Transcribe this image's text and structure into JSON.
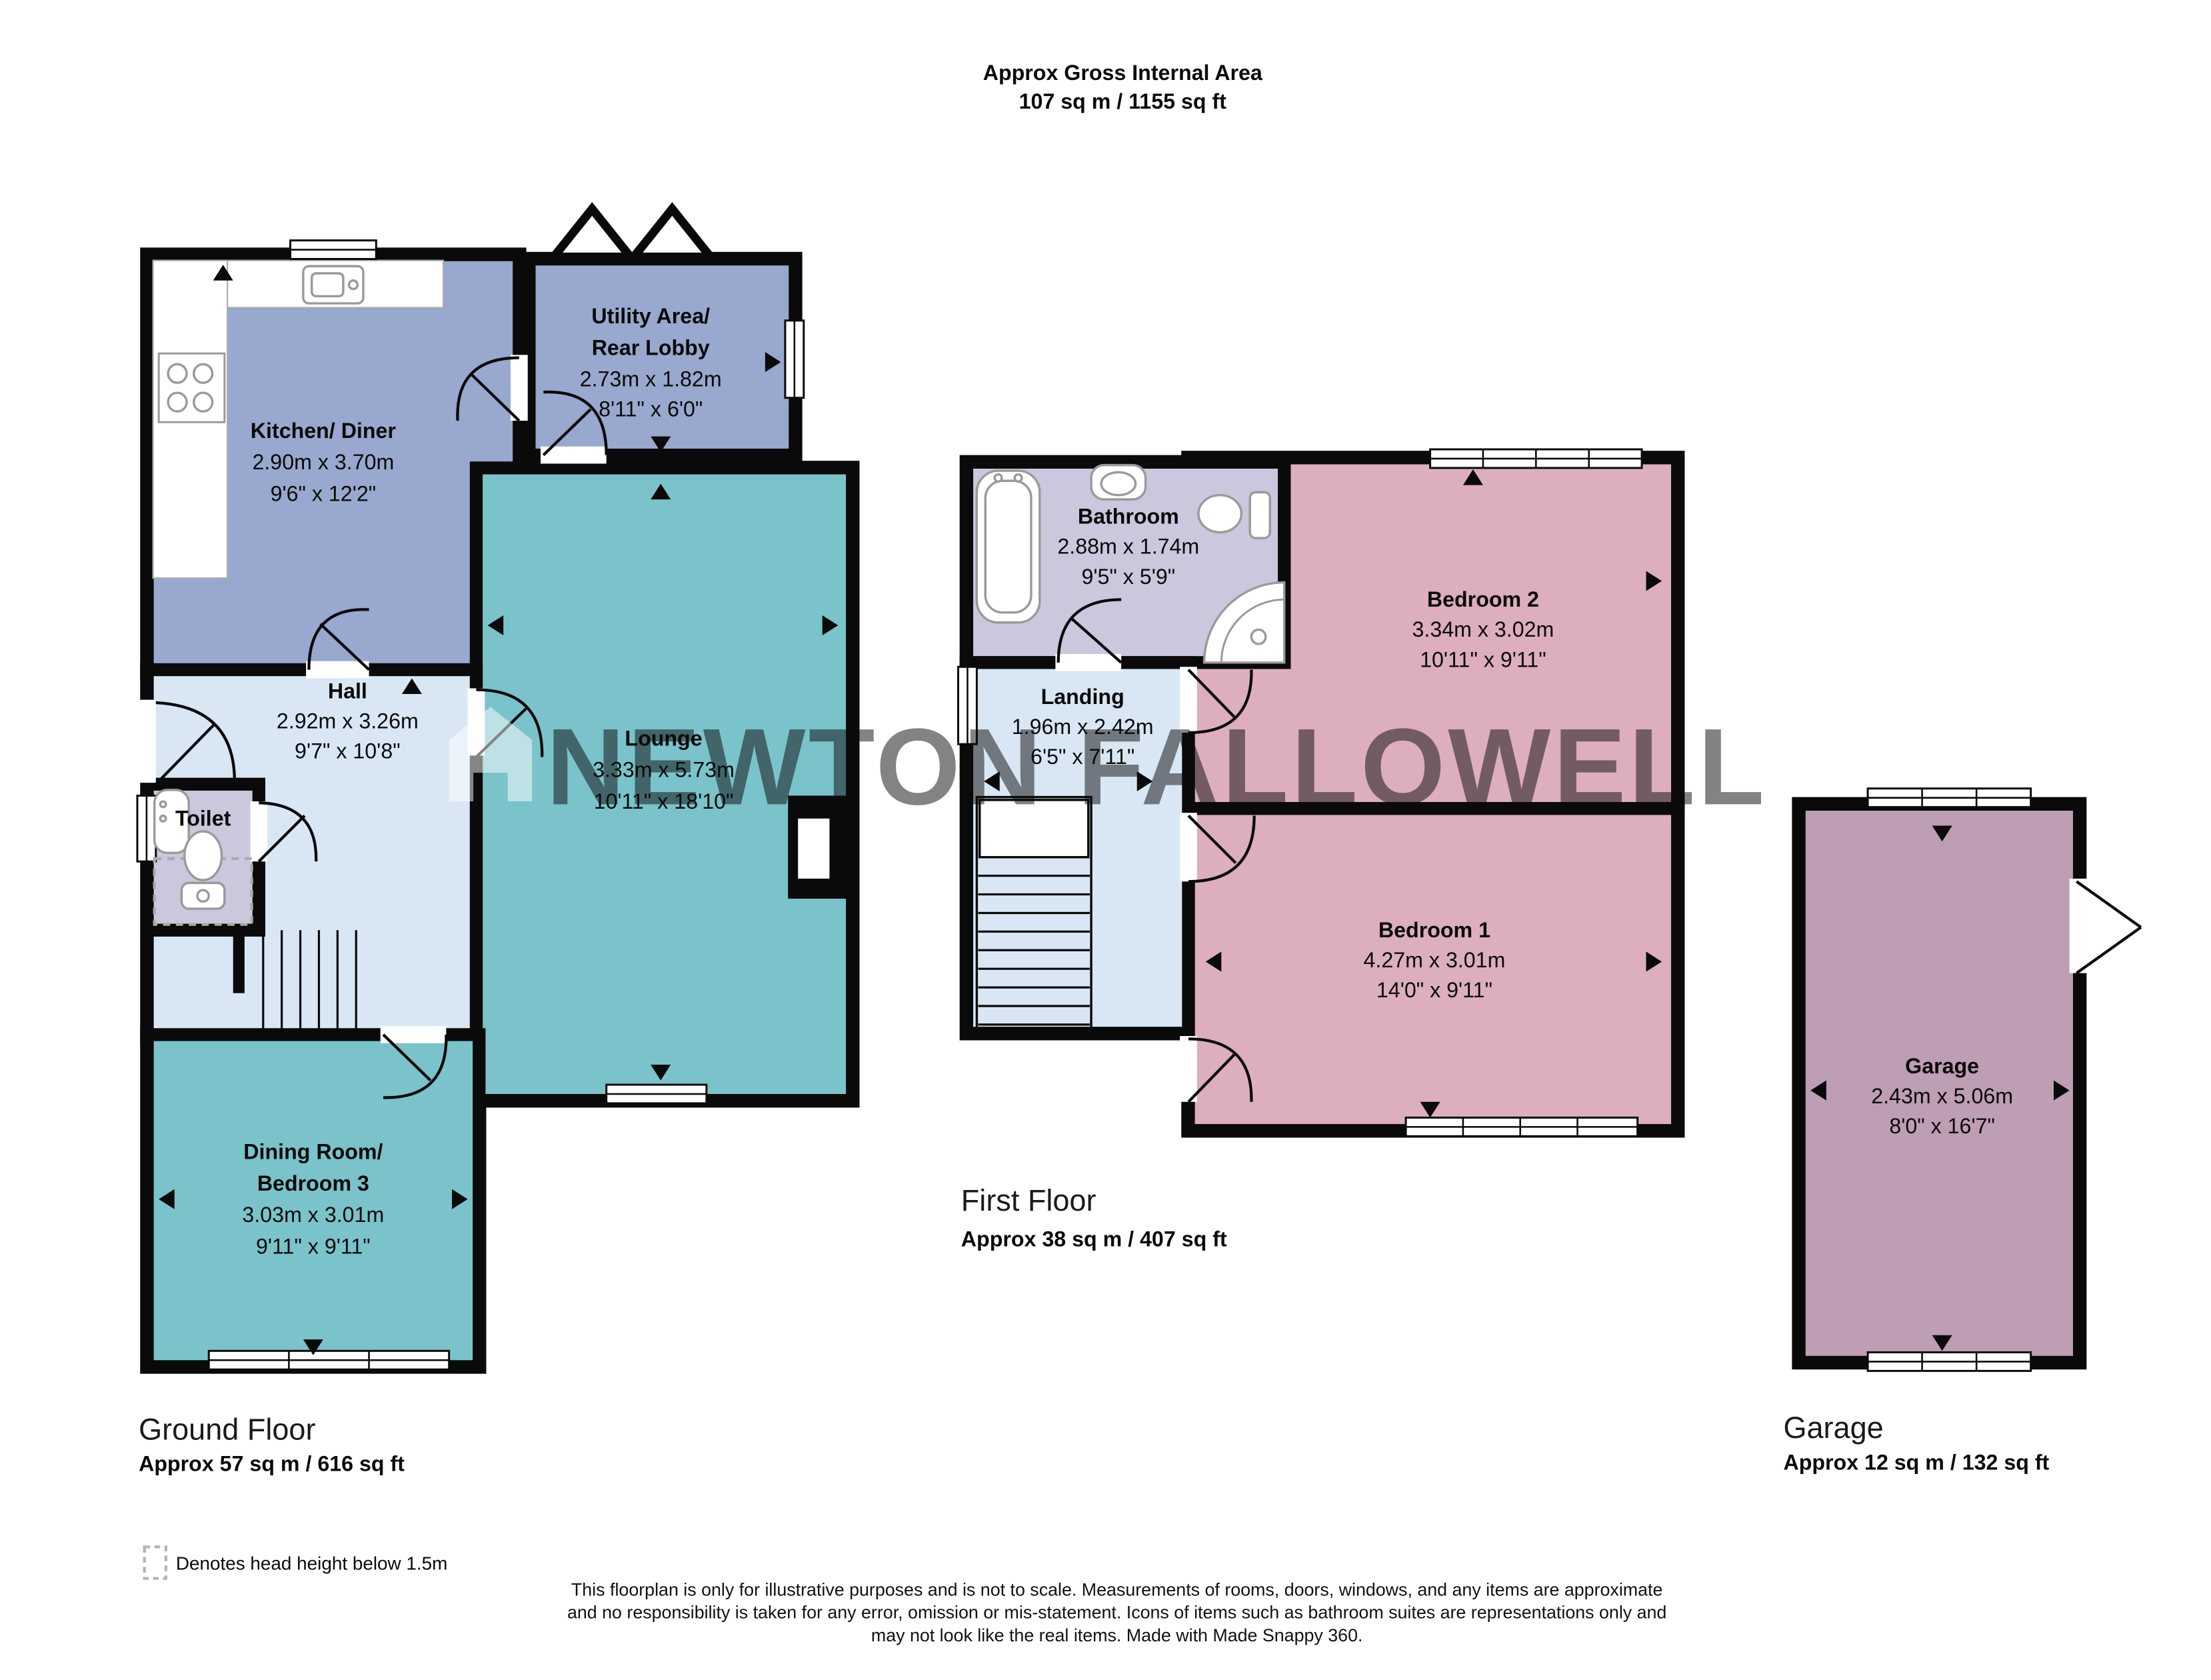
{
  "header": {
    "title_line1": "Approx Gross Internal Area",
    "title_line2": "107 sq m / 1155 sq ft"
  },
  "watermark": {
    "text": "NEWTON FALLOWELL"
  },
  "sections": {
    "ground": {
      "label": "Ground Floor",
      "area": "Approx 57 sq m / 616 sq ft"
    },
    "first": {
      "label": "First Floor",
      "area": "Approx 38 sq m / 407 sq ft"
    },
    "garage": {
      "label": "Garage",
      "area": "Approx 12 sq m / 132 sq ft"
    }
  },
  "rooms": {
    "kitchen": {
      "name": "Kitchen/ Diner",
      "metric": "2.90m x 3.70m",
      "imperial": "9'6\" x 12'2\""
    },
    "utility": {
      "name_line1": "Utility Area/",
      "name_line2": "Rear Lobby",
      "metric": "2.73m x 1.82m",
      "imperial": "8'11\" x 6'0\""
    },
    "lounge": {
      "name": "Lounge",
      "metric": "3.33m x 5.73m",
      "imperial": "10'11\" x 18'10\""
    },
    "hall": {
      "name": "Hall",
      "metric": "2.92m x 3.26m",
      "imperial": "9'7\" x 10'8\""
    },
    "toilet": {
      "name": "Toilet"
    },
    "dining": {
      "name_line1": "Dining Room/",
      "name_line2": "Bedroom 3",
      "metric": "3.03m x 3.01m",
      "imperial": "9'11\" x 9'11\""
    },
    "bathroom": {
      "name": "Bathroom",
      "metric": "2.88m x 1.74m",
      "imperial": "9'5\" x 5'9\""
    },
    "landing": {
      "name": "Landing",
      "metric": "1.96m x 2.42m",
      "imperial": "6'5\" x 7'11\""
    },
    "bedroom2": {
      "name": "Bedroom 2",
      "metric": "3.34m x 3.02m",
      "imperial": "10'11\" x 9'11\""
    },
    "bedroom1": {
      "name": "Bedroom 1",
      "metric": "4.27m x 3.01m",
      "imperial": "14'0\" x 9'11\""
    },
    "garage": {
      "name": "Garage",
      "metric": "2.43m x 5.06m",
      "imperial": "8'0\" x 16'7\""
    }
  },
  "legend": {
    "text": "Denotes head height below 1.5m"
  },
  "disclaimer": {
    "line1": "This floorplan is only for illustrative purposes and is not to scale. Measurements of rooms, doors, windows, and any items are approximate",
    "line2": "and no responsibility is taken for any error, omission or mis-statement. Icons of items such as bathroom suites are representations only and",
    "line3": "may not look like the real items. Made with Made Snappy 360."
  },
  "colors": {
    "kitchen_diner": "#98A8CE",
    "utility": "#98A8CE",
    "lounge": "#7AC3CA",
    "dining": "#7AC3CA",
    "hall": "#D9E7F5",
    "landing": "#D9E7F5",
    "toilet": "#CBC7DD",
    "bathroom": "#CBC7DD",
    "bedroom": "#DCAEBE",
    "garage": "#BD9EB4",
    "wall": "#0A0A0A"
  }
}
